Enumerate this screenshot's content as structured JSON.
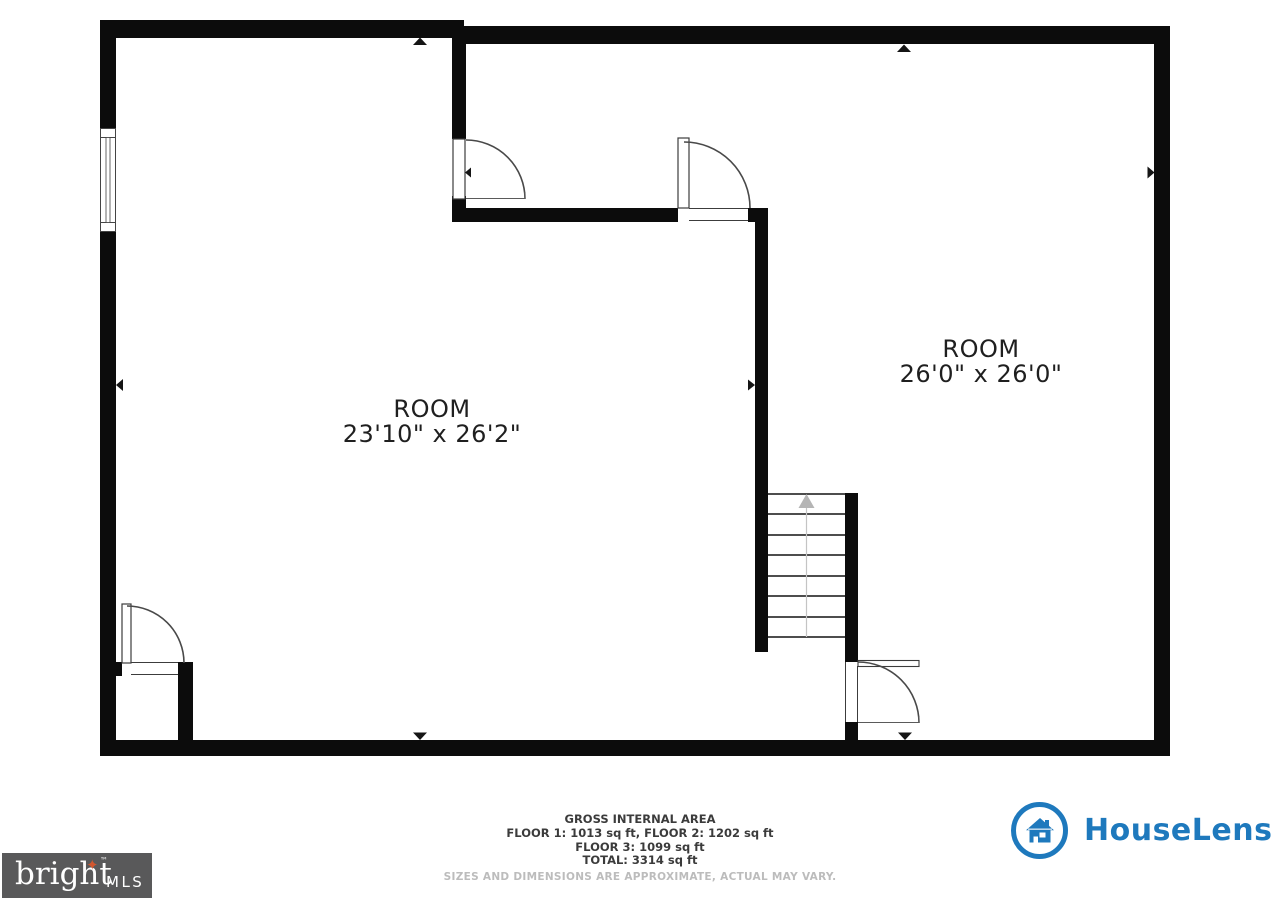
{
  "plan": {
    "rooms": [
      {
        "name": "ROOM",
        "dimensions": "23'10\" x 26'2\""
      },
      {
        "name": "ROOM",
        "dimensions": "26'0\" x 26'0\""
      }
    ],
    "stairs_direction": "up"
  },
  "footer": {
    "area_summary": {
      "title": "GROSS INTERNAL AREA",
      "floors_line_1": "FLOOR 1: 1013 sq ft, FLOOR 2: 1202 sq ft",
      "floors_line_2": "FLOOR 3: 1099 sq ft",
      "total_line": "TOTAL: 3314 sq ft",
      "disclaimer": "SIZES AND DIMENSIONS ARE APPROXIMATE, ACTUAL MAY VARY."
    },
    "houselens": {
      "brand": "HouseLens",
      "brand_color": "#1e79bd"
    },
    "bright_mls": {
      "brand": "bright",
      "suffix": "MLS",
      "trademark": "™",
      "star": "✦",
      "background": "#59595a",
      "star_color": "#d2572f"
    }
  }
}
